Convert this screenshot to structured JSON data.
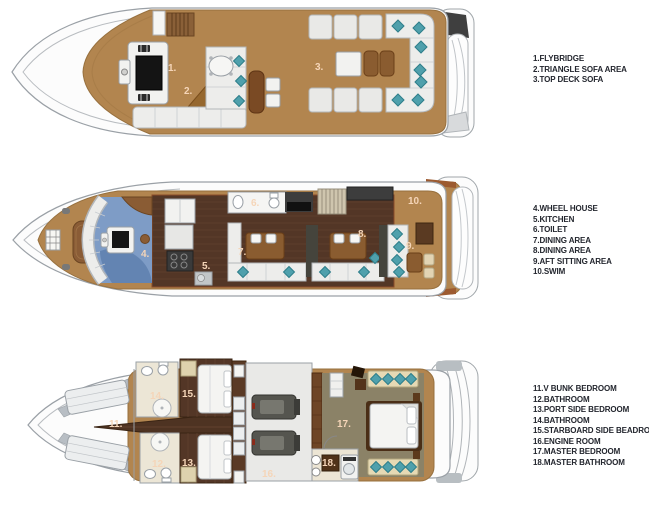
{
  "plan_labels": {
    "flybridge": [
      "1.",
      "2.",
      "3."
    ],
    "main": [
      "4.",
      "5.",
      "6.",
      "7.",
      "8.",
      "9.",
      "10."
    ],
    "lower": [
      "11.",
      "12.",
      "13.",
      "14.",
      "15.",
      "16.",
      "17.",
      "18."
    ]
  },
  "legend": {
    "flybridge": [
      "1.FLYBRIDGE",
      "2.TRIANGLE SOFA AREA",
      "3.TOP DECK SOFA"
    ],
    "main": [
      "4.WHEEL HOUSE",
      "5.KITCHEN",
      "6.TOILET",
      "7.DINING AREA",
      "8.DINING AREA",
      "9.AFT SITTING AREA",
      "10.SWIM"
    ],
    "lower": [
      "11.V BUNK BEDROOM",
      "12.BATHROOM",
      "13.PORT SIDE BEDROOM",
      "14.BATHROOM",
      "15.STARBOARD SIDE BEADROOM",
      "16.ENGINE ROOM",
      "17.MASTER BEDROOM",
      "18.MASTER BATHROOM"
    ]
  },
  "colors": {
    "deck_wood": "#b2854f",
    "interior_dark_wood": "#533626",
    "hull_white": "#fcfcfc",
    "pillow_teal": "#4fa0ac",
    "wheelhouse_blue": "#7e9cc6",
    "furniture_brown": "#8a5c30",
    "label_peach": "#f5d5b8",
    "legend_text": "#23262e"
  }
}
